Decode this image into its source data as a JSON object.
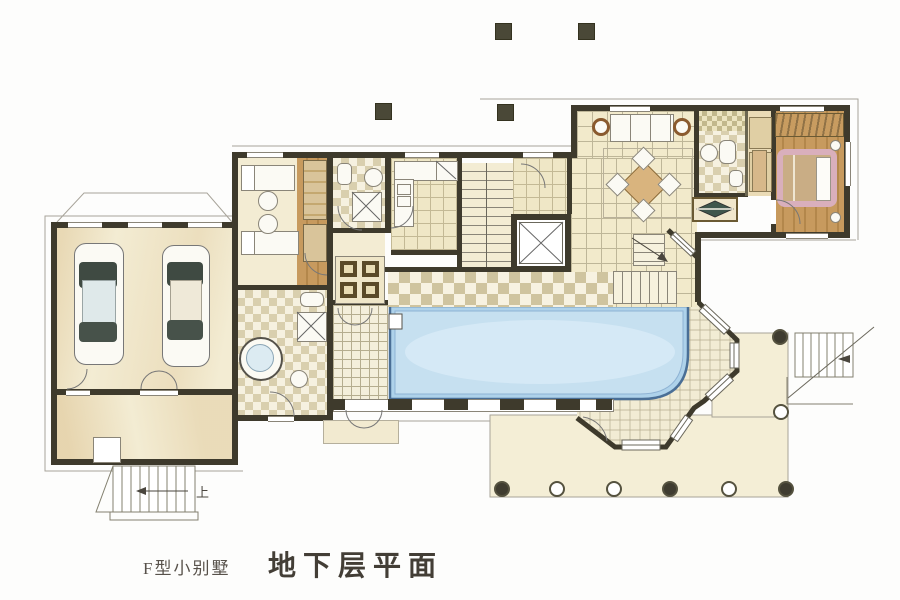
{
  "captions": {
    "model": "F型小别墅",
    "plan_title": "地下层平面"
  },
  "annotations": {
    "stairs_up_label": "上"
  },
  "palette": {
    "wall_ink": "#3e3a2c",
    "floor_beige": "#f3ecd3",
    "floor_wash": "#e4cf9e",
    "wood": "#c79a5e",
    "wood_dark": "#b3874b",
    "checker_dark": "#cfc49f",
    "checker_light": "#f7f2e1",
    "pool_fill": "#aed2ea",
    "pool_inner": "#c6e0f0",
    "pool_edge": "#4a6f96",
    "bed_frame_pink": "#d9afbc",
    "bed_blanket": "#c9ad85",
    "terrace": "#f4eed6",
    "caption_ink": "#46413a"
  },
  "structure": {
    "plan_level": "basement",
    "rooms": [
      "garage",
      "driveway-room",
      "bathroom-round-tub",
      "staff-bedroom",
      "bathroom-north",
      "foyer-inlay",
      "kitchen",
      "stairwell",
      "elevator",
      "corridor",
      "family-hall",
      "living-area",
      "bathroom-east",
      "closet",
      "bedroom",
      "pool-hall",
      "changing-room",
      "octagonal-bay",
      "terrace"
    ],
    "cars_in_garage": 2,
    "pools": 1,
    "elevators": 1,
    "interior_staircases": 2,
    "exterior_staircases": 2,
    "floating_columns": 4,
    "terrace_columns_bottom_row": [
      "filled",
      "open",
      "open",
      "filled",
      "open",
      "filled"
    ]
  }
}
